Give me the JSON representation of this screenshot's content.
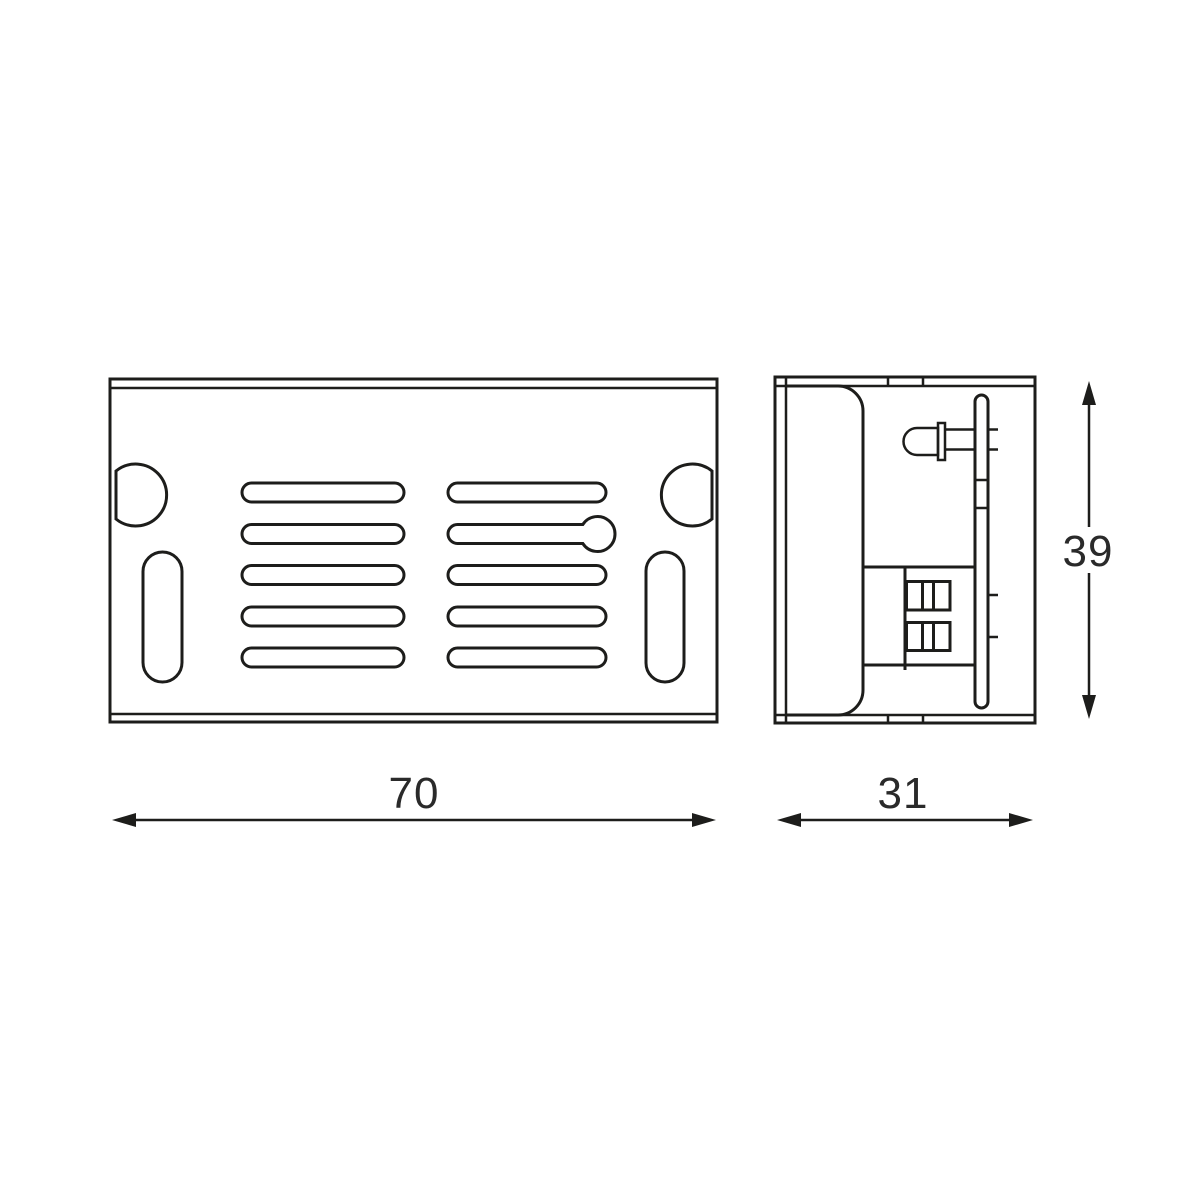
{
  "drawing": {
    "type": "technical-dimension-drawing",
    "views": {
      "front": {
        "features": [
          "vent-slots",
          "keyhole-slot",
          "corner-d-cutouts",
          "oblong-mounting-slots"
        ]
      },
      "side": {
        "features": [
          "led-indicator",
          "pcb-board",
          "terminal-block",
          "body-profile"
        ]
      }
    }
  },
  "dimensions": {
    "front_width": "70",
    "side_width": "31",
    "side_height": "39"
  },
  "colors": {
    "line": "#1d1d1b",
    "text": "#2a2a2a",
    "background": "#ffffff"
  }
}
